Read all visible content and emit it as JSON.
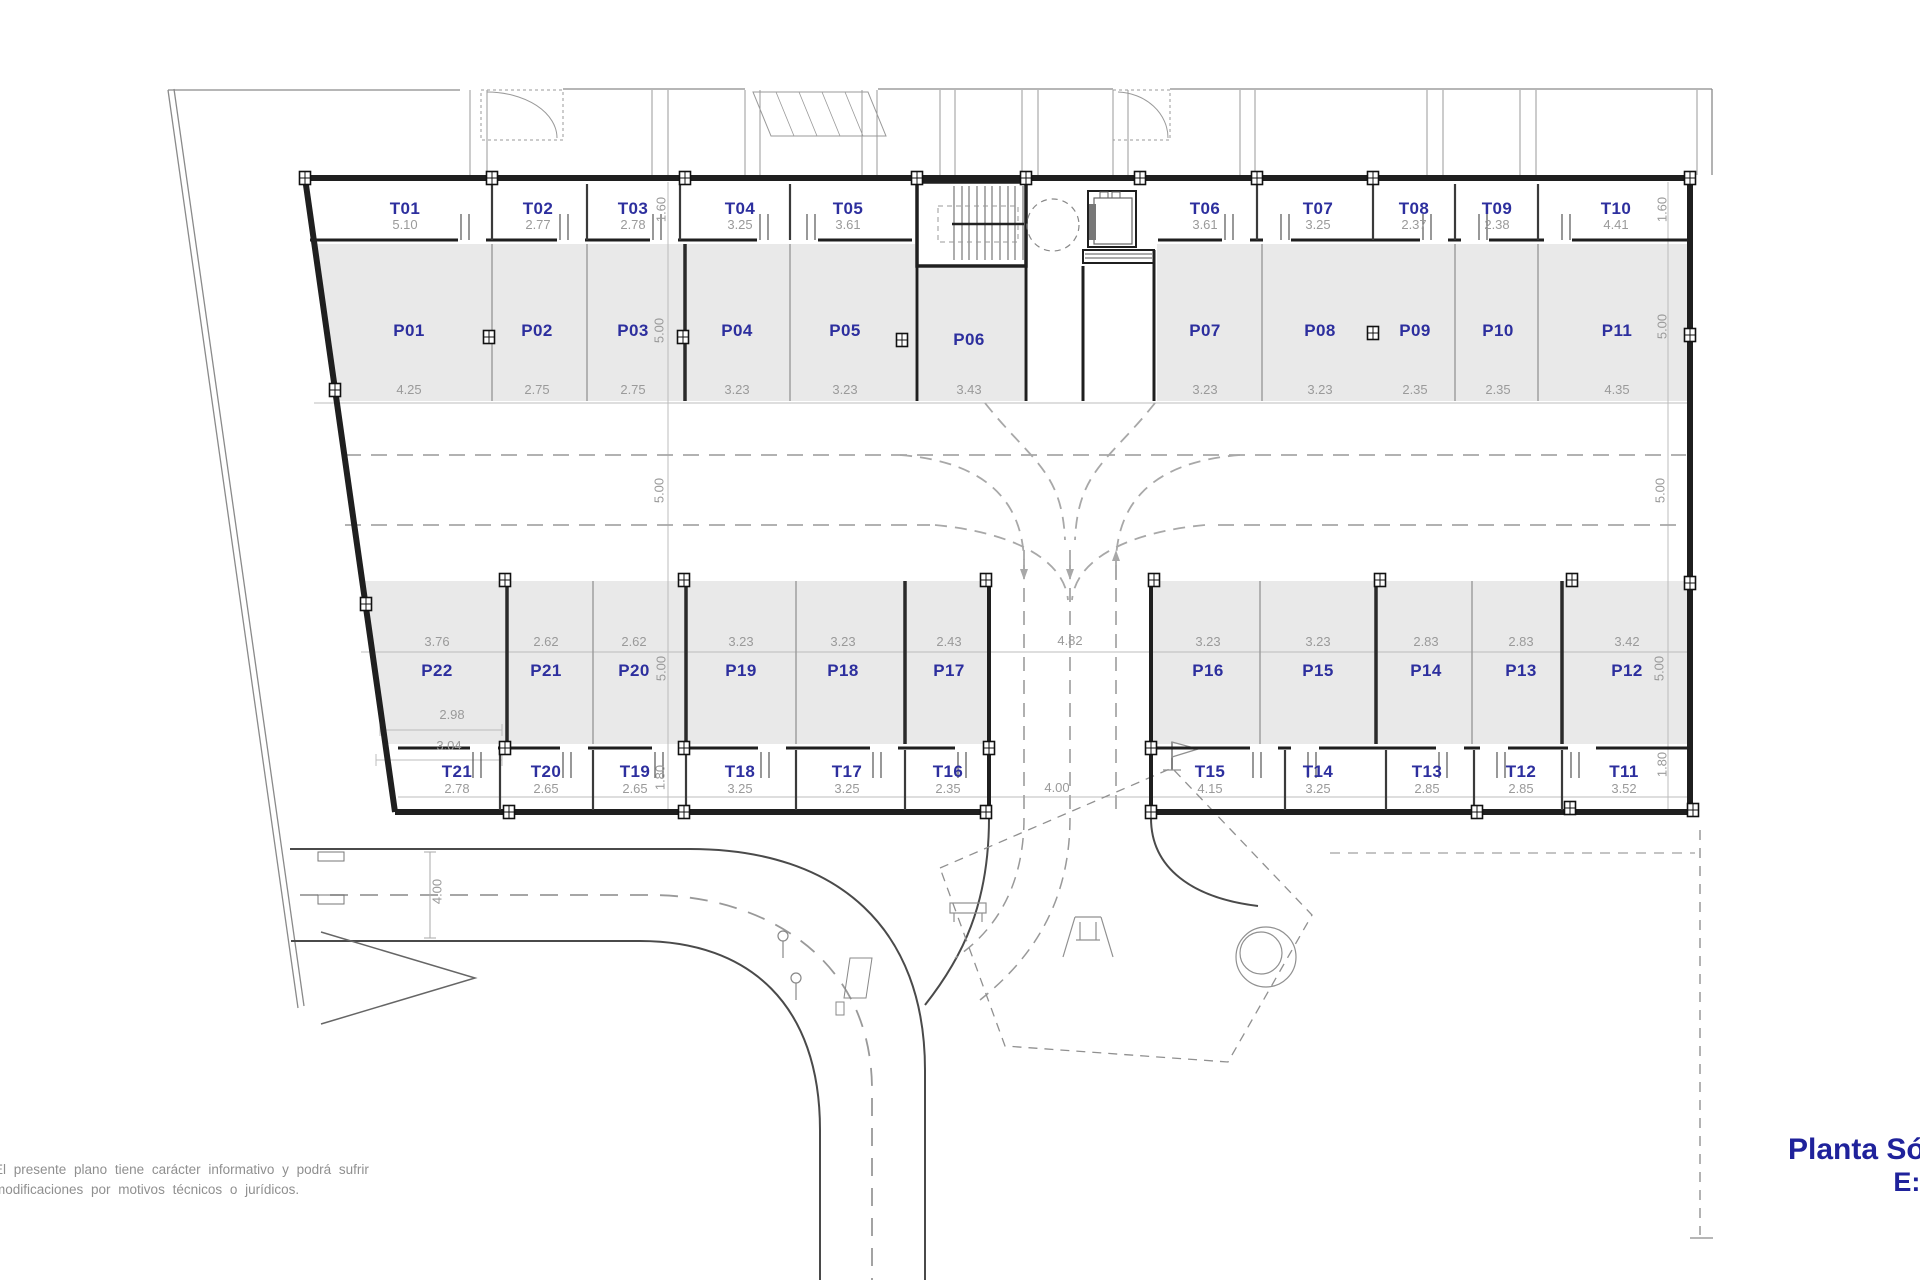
{
  "title": {
    "line1": "Planta Sótano",
    "line2": "E:1/150"
  },
  "disclaimer": {
    "line1": "El presente plano tiene carácter informativo y podrá sufrir",
    "line2": "modificaciones por motivos técnicos o jurídicos."
  },
  "colors": {
    "room_label_blue": "#2d2f9e",
    "dimension_gray": "#9a9a9a",
    "stall_fill": "#e9e9e9",
    "wall_dark": "#1f1f1f",
    "title_blue": "#1f229b"
  },
  "storage_top": [
    {
      "id": "T01",
      "dim": "5.10"
    },
    {
      "id": "T02",
      "dim": "2.77"
    },
    {
      "id": "T03",
      "dim": "2.78"
    },
    {
      "id": "T04",
      "dim": "3.25"
    },
    {
      "id": "T05",
      "dim": "3.61"
    },
    {
      "id": "T06",
      "dim": "3.61"
    },
    {
      "id": "T07",
      "dim": "3.25"
    },
    {
      "id": "T08",
      "dim": "2.37"
    },
    {
      "id": "T09",
      "dim": "2.38"
    },
    {
      "id": "T10",
      "dim": "4.41"
    }
  ],
  "parking_top": [
    {
      "id": "P01",
      "dim": "4.25"
    },
    {
      "id": "P02",
      "dim": "2.75"
    },
    {
      "id": "P03",
      "dim": "2.75"
    },
    {
      "id": "P04",
      "dim": "3.23"
    },
    {
      "id": "P05",
      "dim": "3.23"
    },
    {
      "id": "P06",
      "dim": "3.43"
    },
    {
      "id": "P07",
      "dim": "3.23"
    },
    {
      "id": "P08",
      "dim": "3.23"
    },
    {
      "id": "P09",
      "dim": "2.35"
    },
    {
      "id": "P10",
      "dim": "2.35"
    },
    {
      "id": "P11",
      "dim": "4.35"
    }
  ],
  "parking_bottom": [
    {
      "id": "P22",
      "dim": "3.76"
    },
    {
      "id": "P21",
      "dim": "2.62"
    },
    {
      "id": "P20",
      "dim": "2.62"
    },
    {
      "id": "P19",
      "dim": "3.23"
    },
    {
      "id": "P18",
      "dim": "3.23"
    },
    {
      "id": "P17",
      "dim": "2.43"
    },
    {
      "id": "P16",
      "dim": "3.23"
    },
    {
      "id": "P15",
      "dim": "3.23"
    },
    {
      "id": "P14",
      "dim": "2.83"
    },
    {
      "id": "P13",
      "dim": "2.83"
    },
    {
      "id": "P12",
      "dim": "3.42"
    }
  ],
  "storage_bottom": [
    {
      "id": "T21",
      "dim": "2.78"
    },
    {
      "id": "T20",
      "dim": "2.65"
    },
    {
      "id": "T19",
      "dim": "2.65"
    },
    {
      "id": "T18",
      "dim": "3.25"
    },
    {
      "id": "T17",
      "dim": "3.25"
    },
    {
      "id": "T16",
      "dim": "2.35"
    },
    {
      "id": "T15",
      "dim": "4.15"
    },
    {
      "id": "T14",
      "dim": "3.25"
    },
    {
      "id": "T13",
      "dim": "2.85"
    },
    {
      "id": "T12",
      "dim": "2.85"
    },
    {
      "id": "T11",
      "dim": "3.52"
    }
  ],
  "dims": {
    "v160_left": "1.60",
    "v160_right": "1.60",
    "v500_top_left": "5.00",
    "v500_top_right": "5.00",
    "v500_aisle_left": "5.00",
    "v500_aisle_right": "5.00",
    "v500_bottom_left": "5.00",
    "v500_bottom_right": "5.00",
    "v180_left": "1.80",
    "v180_right": "1.80",
    "p22_depth": "2.98",
    "t21_width": "3.04",
    "ramp_width": "4.82",
    "ramp_exit": "4.00",
    "road_width": "4.00"
  }
}
